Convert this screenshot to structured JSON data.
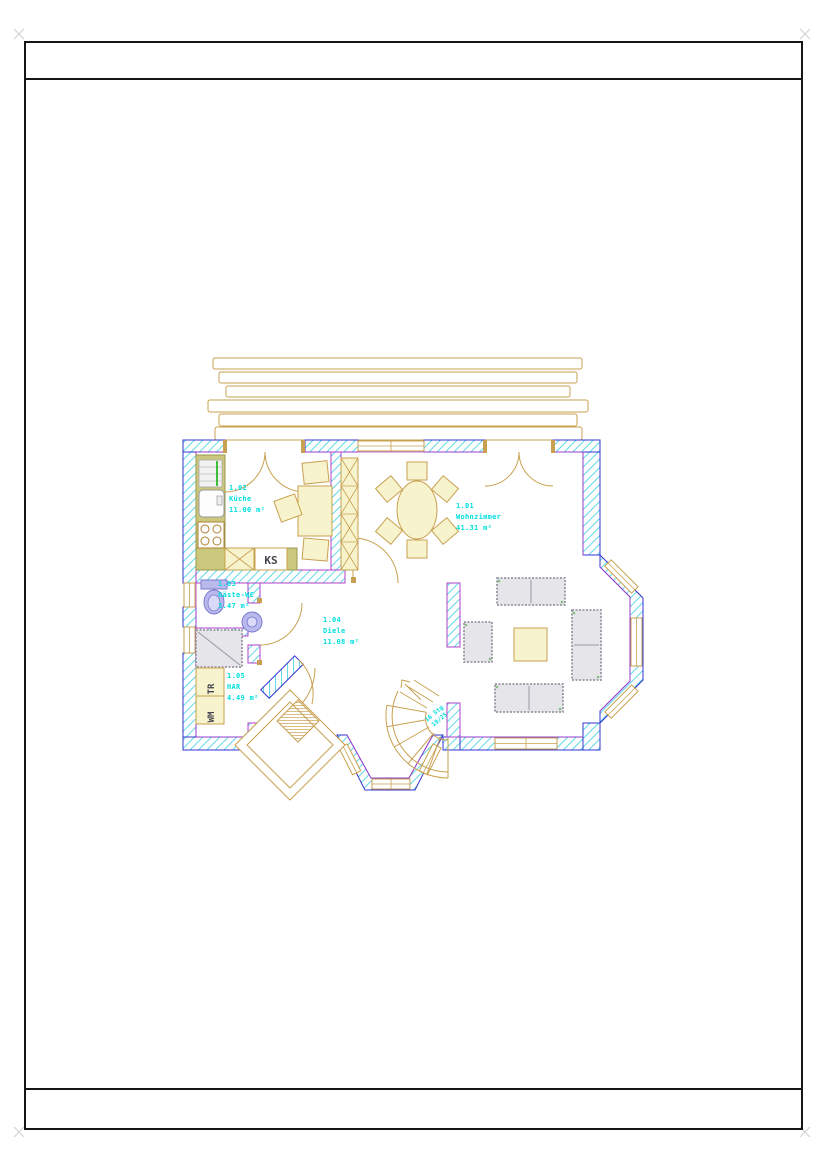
{
  "plan": {
    "rooms": [
      {
        "number": "1.01",
        "name": "Wohnzimmer",
        "area": "41.31 m²"
      },
      {
        "number": "1.02",
        "name": "Küche",
        "area": "11.00 m²"
      },
      {
        "number": "1.03",
        "name": "Gäste-WC",
        "area": "3.47 m²"
      },
      {
        "number": "1.04",
        "name": "Diele",
        "area": "11.08 m²"
      },
      {
        "number": "1.05",
        "name": "HAR",
        "area": "4.49 m²"
      }
    ],
    "appliances": {
      "fridge": "KS",
      "dryer": "TR",
      "washer": "WM"
    },
    "stairs": {
      "line1": "16 Stg",
      "line2": "19/25"
    },
    "colors": {
      "wall_hatch": "#5fd8e8",
      "wall_edge_blue": "#3434d0",
      "wall_edge_magenta": "#b040c8",
      "cad_line_tan": "#c8a050",
      "room_text_cyan": "#00dede",
      "furniture_gray": "#e6e6ea",
      "furniture_yellow": "#f7f3cd",
      "kitchen_counter_olive": "#cbc77d",
      "fixture_lavender": "#b9b9ec"
    }
  }
}
